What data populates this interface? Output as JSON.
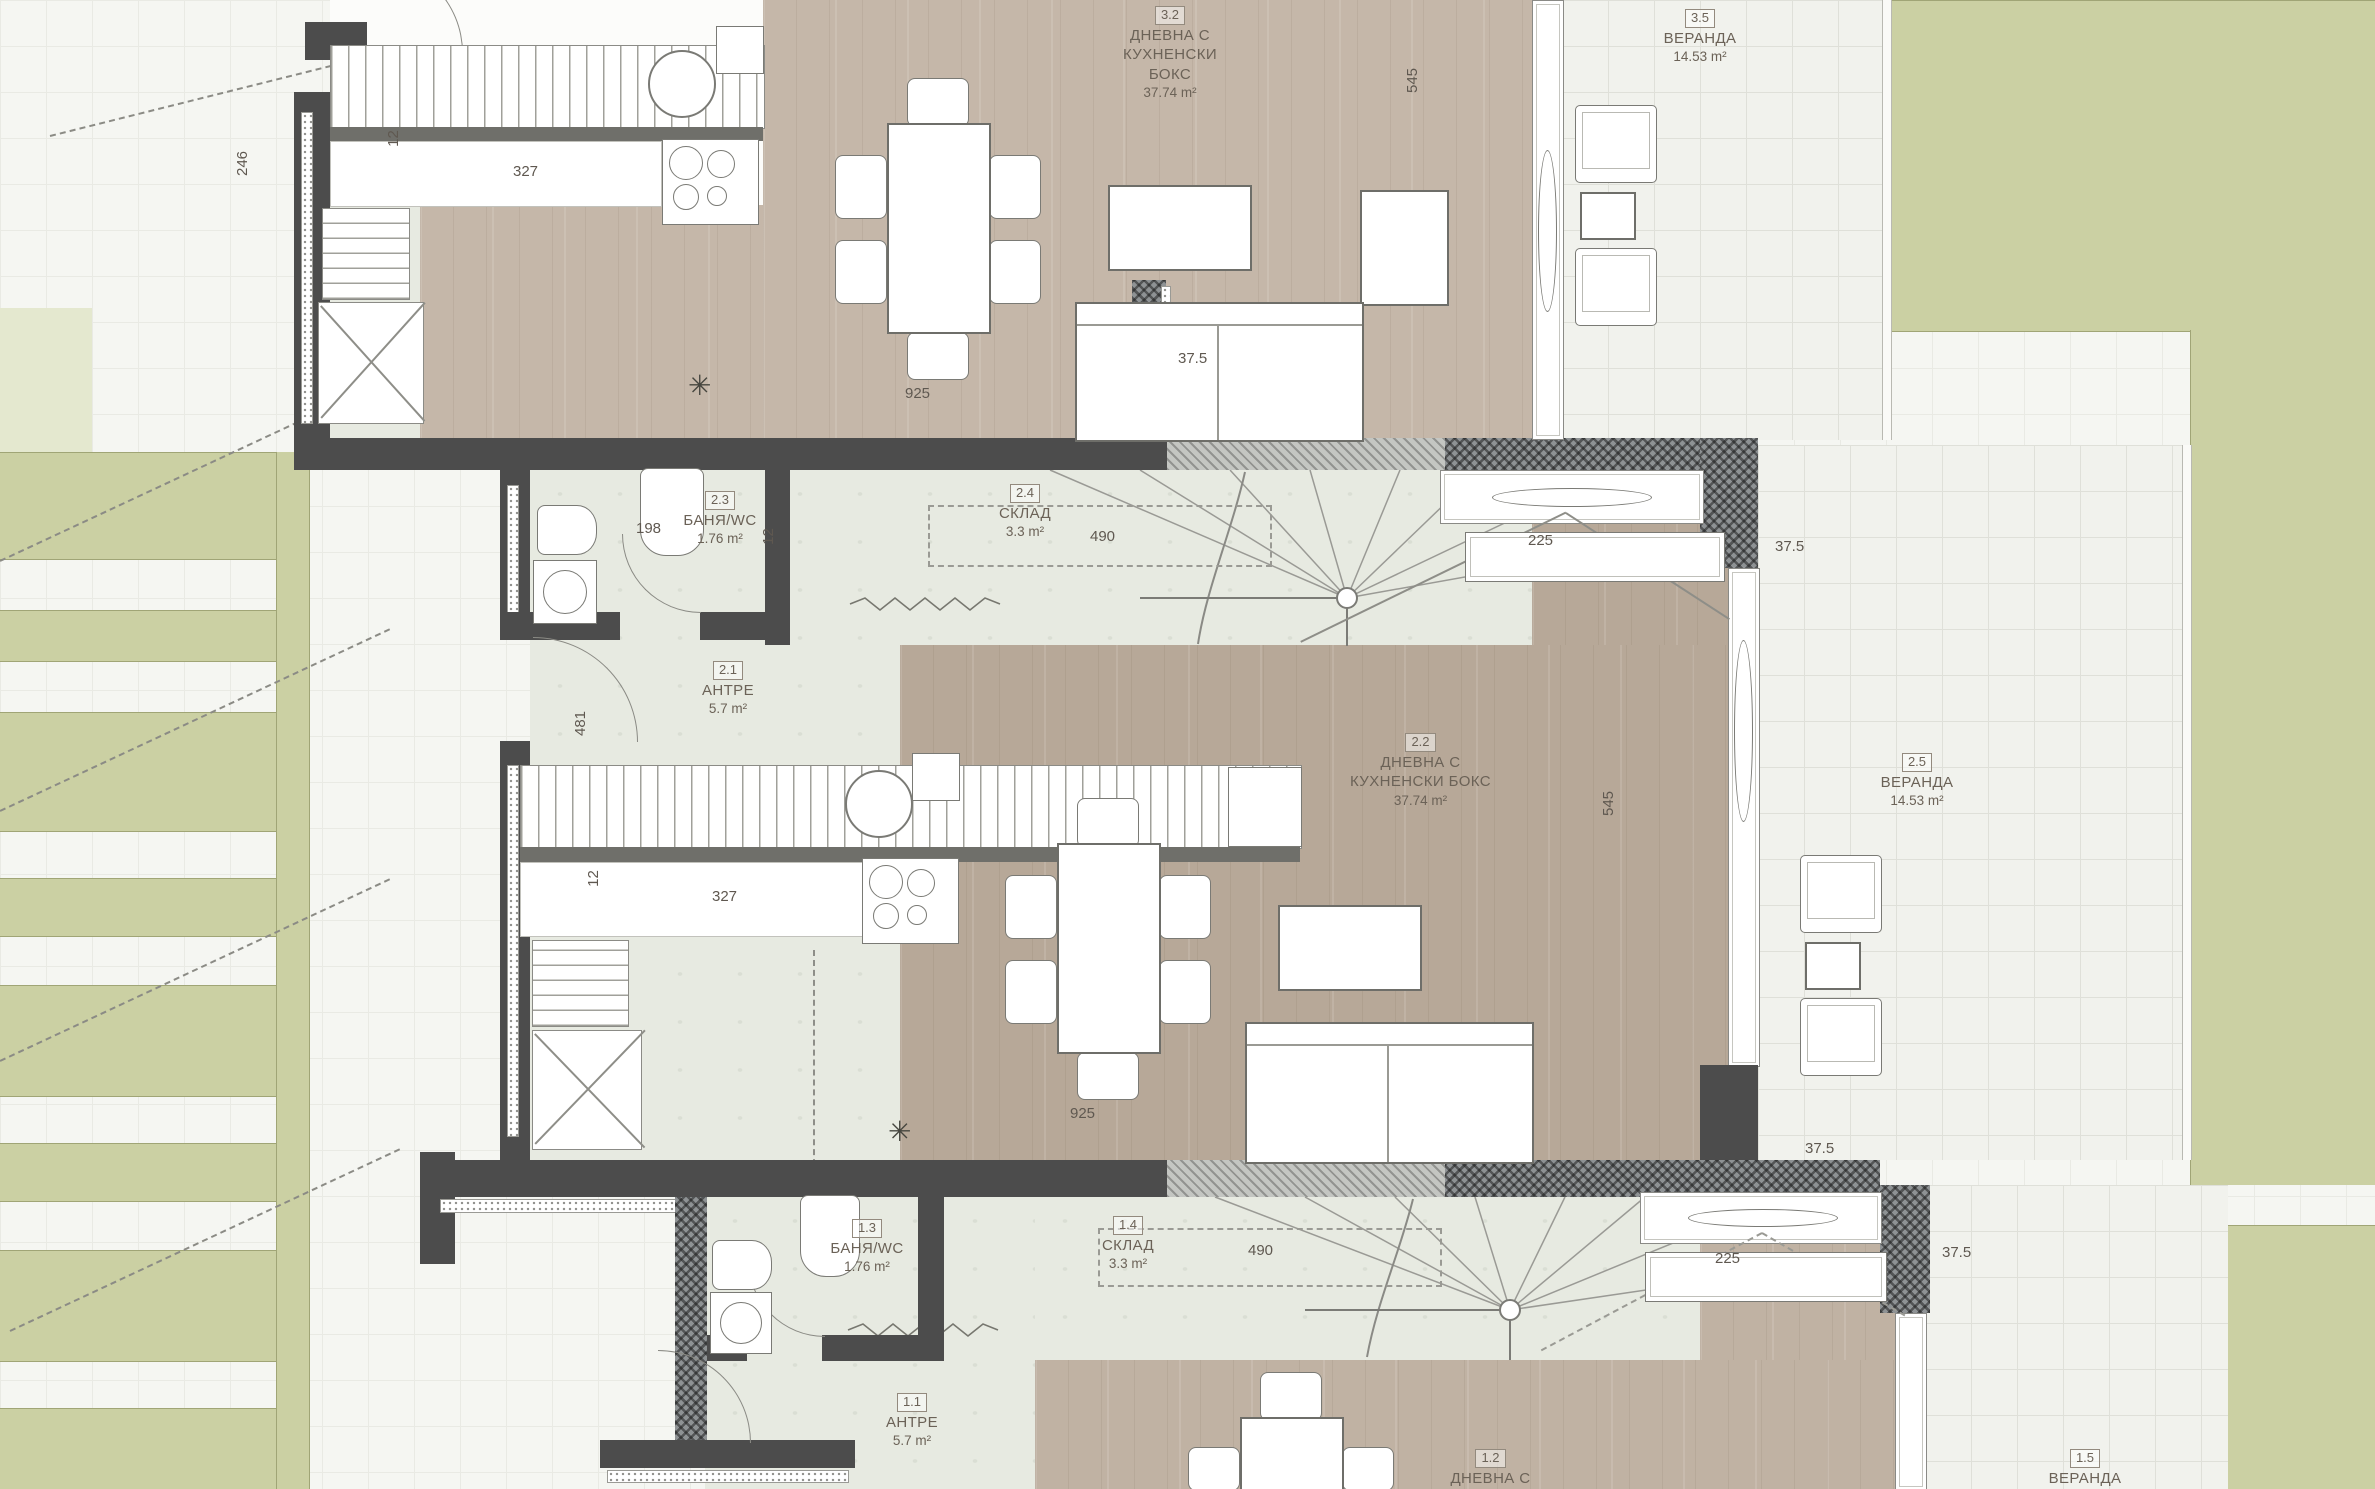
{
  "rooms": {
    "r32": {
      "num": "3.2",
      "nm": "ДНЕВНА С",
      "nm2": "КУХНЕНСКИ БОКС",
      "ar": "37.74 m²"
    },
    "r35": {
      "num": "3.5",
      "nm": "ВЕРАНДА",
      "ar": "14.53 m²"
    },
    "r21": {
      "num": "2.1",
      "nm": "АНТРЕ",
      "ar": "5.7 m²"
    },
    "r22": {
      "num": "2.2",
      "nm": "ДНЕВНА С",
      "nm2": "КУХНЕНСКИ БОКС",
      "ar": "37.74 m²"
    },
    "r23": {
      "num": "2.3",
      "nm": "БАНЯ/WC",
      "ar": "1.76 m²"
    },
    "r24": {
      "num": "2.4",
      "nm": "СКЛАД",
      "ar": "3.3 m²"
    },
    "r25": {
      "num": "2.5",
      "nm": "ВЕРАНДА",
      "ar": "14.53 m²"
    },
    "r11": {
      "num": "1.1",
      "nm": "АНТРЕ",
      "ar": "5.7 m²"
    },
    "r12": {
      "num": "1.2",
      "nm": "ДНЕВНА С"
    },
    "r13": {
      "num": "1.3",
      "nm": "БАНЯ/WC",
      "ar": "1.76 m²"
    },
    "r14": {
      "num": "1.4",
      "nm": "СКЛАД",
      "ar": "3.3 m²"
    },
    "r15": {
      "num": "1.5",
      "nm": "ВЕРАНДА"
    }
  },
  "dims": {
    "v327": "327",
    "v12": "12",
    "v246": "246",
    "v481": "481",
    "v198": "198",
    "v490": "490",
    "v925": "925",
    "v545": "545",
    "v225": "225",
    "v375": "37.5"
  },
  "symbols": {
    "snowflake": "✳"
  },
  "colors": {
    "green": "#cbd0a3",
    "wood_mid": "#b7a898",
    "wood_top": "#c5b7a9",
    "wood_bottom": "#c0b2a3",
    "marble": "#e7eae1",
    "wall": "#4c4c4c",
    "paving": "#f5f6f2"
  }
}
